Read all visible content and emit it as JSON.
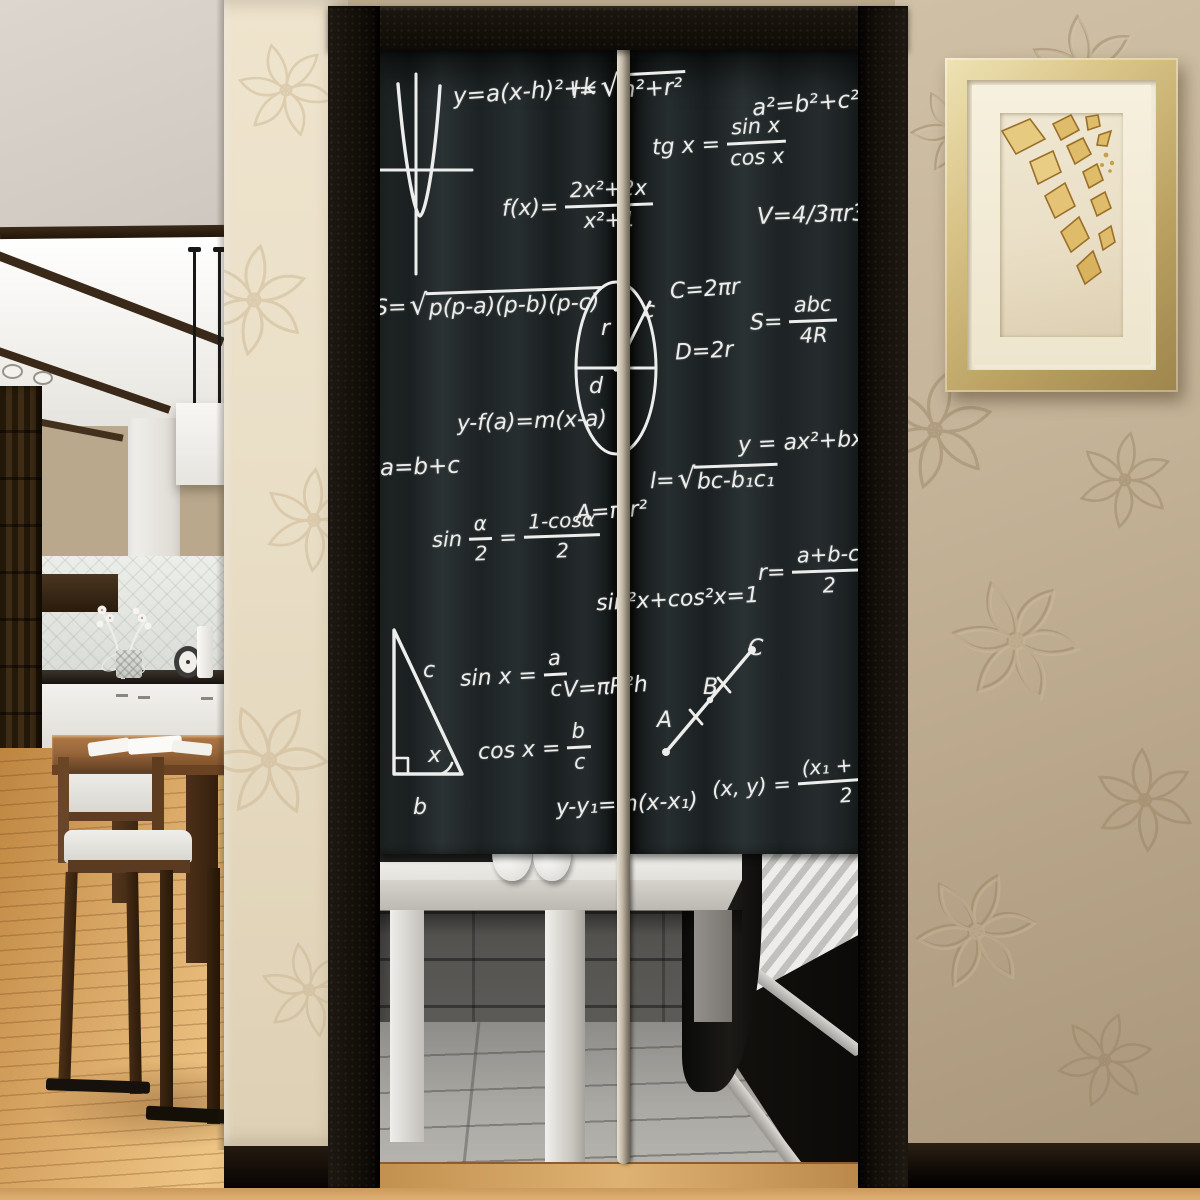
{
  "description": "Noren doorway curtain printed with blackboard math formulas, hanging in a black door frame; kitchen-dining room at left, embossed tan wallpaper and gold-framed leaf artwork at right",
  "palette": {
    "chalk": "#edeeec",
    "curtain_dark": "#1b2021",
    "curtain_light": "#2b3233",
    "frame_black": "#14100a",
    "pole": "#cdc4b4",
    "wall_right": "#c2b094",
    "wall_left_column": "#e9dec6",
    "frame_gold": "#d6c083",
    "mat_cream": "#f3ecd9",
    "art_gold": "#dfbc6a",
    "wood_floor": "#d9a765",
    "stone_wall": "#4c4a47",
    "tile_floor": "#a09e99",
    "table_white": "#eceae6"
  },
  "curtain": {
    "formulas": [
      {
        "id": "parabola-eq",
        "x": 79,
        "y": 32,
        "fs": 23,
        "r": -4,
        "s": [
          {
            "t": "x",
            "v": "y=a(x-h)²+k"
          }
        ]
      },
      {
        "id": "slant-height",
        "x": 198,
        "y": 25,
        "fs": 23,
        "r": -3,
        "s": [
          {
            "t": "x",
            "v": "l="
          },
          {
            "t": "q",
            "v": "h²+r²"
          }
        ]
      },
      {
        "id": "pythagoras",
        "x": 378,
        "y": 44,
        "fs": 23,
        "r": -5,
        "s": [
          {
            "t": "x",
            "v": "a²=b²+c²"
          }
        ]
      },
      {
        "id": "tangent-def",
        "x": 278,
        "y": 70,
        "fs": 22,
        "r": -3,
        "s": [
          {
            "t": "x",
            "v": "tg x ="
          },
          {
            "t": "f",
            "n": "sin x",
            "d": "cos x"
          }
        ]
      },
      {
        "id": "rational-fn",
        "x": 128,
        "y": 132,
        "fs": 22,
        "r": -2,
        "s": [
          {
            "t": "x",
            "v": "f(x)="
          },
          {
            "t": "f",
            "n": "2x²+2x",
            "d": "x²+1"
          }
        ]
      },
      {
        "id": "sphere-volume",
        "x": 383,
        "y": 155,
        "fs": 23,
        "r": -2,
        "s": [
          {
            "t": "x",
            "v": "V=4/3πr3"
          }
        ]
      },
      {
        "id": "heron",
        "x": 0,
        "y": 242,
        "fs": 22,
        "r": -2,
        "s": [
          {
            "t": "x",
            "v": "S="
          },
          {
            "t": "q",
            "v": "p(p-a)(p-b)(p-c)"
          }
        ]
      },
      {
        "id": "circumference",
        "x": 296,
        "y": 230,
        "fs": 22,
        "r": -4,
        "s": [
          {
            "t": "x",
            "v": "C=2πr"
          }
        ]
      },
      {
        "id": "diameter",
        "x": 301,
        "y": 292,
        "fs": 22,
        "r": -3,
        "s": [
          {
            "t": "x",
            "v": "D=2r"
          }
        ]
      },
      {
        "id": "circumradius",
        "x": 376,
        "y": 247,
        "fs": 22,
        "r": -2,
        "s": [
          {
            "t": "x",
            "v": "S="
          },
          {
            "t": "f",
            "n": "abc",
            "d": "4R"
          }
        ]
      },
      {
        "id": "tangent-line",
        "x": 83,
        "y": 362,
        "fs": 22,
        "r": -2,
        "s": [
          {
            "t": "x",
            "v": "y-f(a)=m(x-a)"
          }
        ]
      },
      {
        "id": "sum",
        "x": 6,
        "y": 407,
        "fs": 23,
        "r": -2,
        "s": [
          {
            "t": "x",
            "v": "a=b+c"
          }
        ]
      },
      {
        "id": "quadratic",
        "x": 364,
        "y": 382,
        "fs": 22,
        "r": -3,
        "s": [
          {
            "t": "x",
            "v": "y = ax²+bx+c"
          }
        ]
      },
      {
        "id": "chord",
        "x": 276,
        "y": 417,
        "fs": 22,
        "r": -2,
        "s": [
          {
            "t": "x",
            "v": "l="
          },
          {
            "t": "q",
            "v": "bc-b₁c₁"
          }
        ]
      },
      {
        "id": "circle-area",
        "x": 202,
        "y": 452,
        "fs": 22,
        "r": -4,
        "s": [
          {
            "t": "x",
            "v": "A=π r²"
          }
        ]
      },
      {
        "id": "half-angle",
        "x": 58,
        "y": 464,
        "fs": 21,
        "r": -2,
        "s": [
          {
            "t": "x",
            "v": "sin"
          },
          {
            "t": "f",
            "n": "α",
            "d": "2"
          },
          {
            "t": "x",
            "v": "="
          },
          {
            "t": "f",
            "n": "1-cosα",
            "d": "2"
          }
        ]
      },
      {
        "id": "pyth-identity",
        "x": 222,
        "y": 540,
        "fs": 22,
        "r": -3,
        "s": [
          {
            "t": "x",
            "v": "sin²x+cos²x=1"
          }
        ]
      },
      {
        "id": "inradius",
        "x": 384,
        "y": 497,
        "fs": 22,
        "r": -2,
        "s": [
          {
            "t": "x",
            "v": "r="
          },
          {
            "t": "f",
            "n": "a+b-c",
            "d": "2"
          }
        ]
      },
      {
        "id": "sine-def",
        "x": 86,
        "y": 602,
        "fs": 22,
        "r": -3,
        "s": [
          {
            "t": "x",
            "v": "sin x ="
          },
          {
            "t": "f",
            "n": "a",
            "d": "c"
          }
        ]
      },
      {
        "id": "cylinder-volume",
        "x": 189,
        "y": 628,
        "fs": 22,
        "r": -4,
        "s": [
          {
            "t": "x",
            "v": "V=πR²h"
          }
        ]
      },
      {
        "id": "cosine-def",
        "x": 104,
        "y": 675,
        "fs": 22,
        "r": -3,
        "s": [
          {
            "t": "x",
            "v": "cos x ="
          },
          {
            "t": "f",
            "n": "b",
            "d": "c"
          }
        ]
      },
      {
        "id": "point-slope",
        "x": 182,
        "y": 745,
        "fs": 22,
        "r": -3,
        "s": [
          {
            "t": "x",
            "v": "y-y₁=m(x-x₁)"
          }
        ]
      },
      {
        "id": "midpoint",
        "x": 338,
        "y": 710,
        "fs": 21,
        "r": -4,
        "s": [
          {
            "t": "x",
            "v": "(x, y) ="
          },
          {
            "t": "f",
            "n": "(x₁ + x₂)",
            "d": "2"
          }
        ]
      }
    ],
    "labels": {
      "circle_r": "r",
      "circle_c": "c",
      "circle_d": "d",
      "tri_a": "a",
      "tri_b": "b",
      "tri_c": "c",
      "tri_x": "x",
      "seg_A": "A",
      "seg_B": "B",
      "seg_C": "C"
    }
  }
}
